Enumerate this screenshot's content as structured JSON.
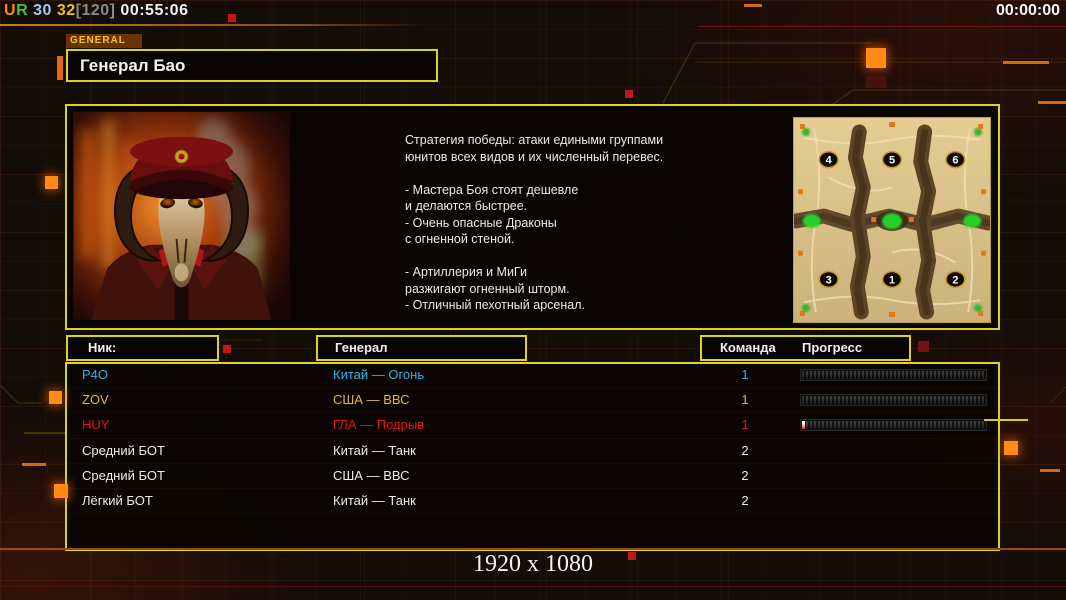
{
  "top_bar": {
    "left_segments": [
      {
        "text": "U",
        "color": "#ff8a00"
      },
      {
        "text": "R",
        "color": "#3cc23c"
      },
      {
        "text": " 30",
        "color": "#a8c8ee"
      },
      {
        "text": " 32",
        "color": "#f0c01c"
      },
      {
        "text": "[120]",
        "color": "#8a8a8a"
      },
      {
        "text": " 00:55:06",
        "color": "#f2f2f2"
      }
    ],
    "right_clock": "00:00:00"
  },
  "general_tab": {
    "label": "GENERAL"
  },
  "title": {
    "text": "Генерал Бао"
  },
  "briefing": {
    "strategy_text": "Стратегия победы: атаки едиными группами\nюнитов всех видов и их численный перевес.\n\n- Мастера Боя стоят дешевле\nи делаются быстрее.\n- Очень опасные Драконы\nс огненной стеной.\n\n- Артиллерия и МиГи\nразжигают огненный шторм.\n- Отличный пехотный арсенал.",
    "minimap": {
      "points": [
        {
          "n": "4",
          "x": 35,
          "y": 42
        },
        {
          "n": "5",
          "x": 99,
          "y": 42
        },
        {
          "n": "6",
          "x": 163,
          "y": 42
        },
        {
          "n": "3",
          "x": 35,
          "y": 163
        },
        {
          "n": "1",
          "x": 99,
          "y": 163
        },
        {
          "n": "2",
          "x": 163,
          "y": 163
        }
      ]
    }
  },
  "table": {
    "headers": {
      "nick": "Ник:",
      "general": "Генерал",
      "team": "Команда",
      "progress": "Прогресс"
    },
    "rows": [
      {
        "nick": "P4O",
        "general": "Китай — Огонь",
        "team": "1",
        "color": "#2fb4e8",
        "has_progress": true,
        "progress_pct": 0
      },
      {
        "nick": "ZOV",
        "general": "США — ВВС",
        "team": "1",
        "color": "#d9bc3f",
        "has_progress": true,
        "progress_pct": 0
      },
      {
        "nick": "HUY",
        "general": "ГЛА — Подрыв",
        "team": "1",
        "color": "#e41414",
        "has_progress": true,
        "progress_pct": 1.6
      },
      {
        "nick": "Средний БОТ",
        "general": "Китай — Танк",
        "team": "2",
        "color": "#ececec",
        "has_progress": false,
        "progress_pct": 0
      },
      {
        "nick": "Средний БОТ",
        "general": "США — ВВС",
        "team": "2",
        "color": "#ececec",
        "has_progress": false,
        "progress_pct": 0
      },
      {
        "nick": "Лёгкий БОТ",
        "general": "Китай — Танк",
        "team": "2",
        "color": "#ececec",
        "has_progress": false,
        "progress_pct": 0
      }
    ]
  },
  "footer": {
    "resolution": "1920 x 1080"
  },
  "colors": {
    "panel_border": "#d8d41f",
    "accent_orange": "#ff8a14",
    "tab_bg": "#6b3305",
    "tab_text": "#f5c51a",
    "map_sand": "#d9c18c",
    "map_ridge": "#553d22",
    "map_green": "#25d02a"
  }
}
